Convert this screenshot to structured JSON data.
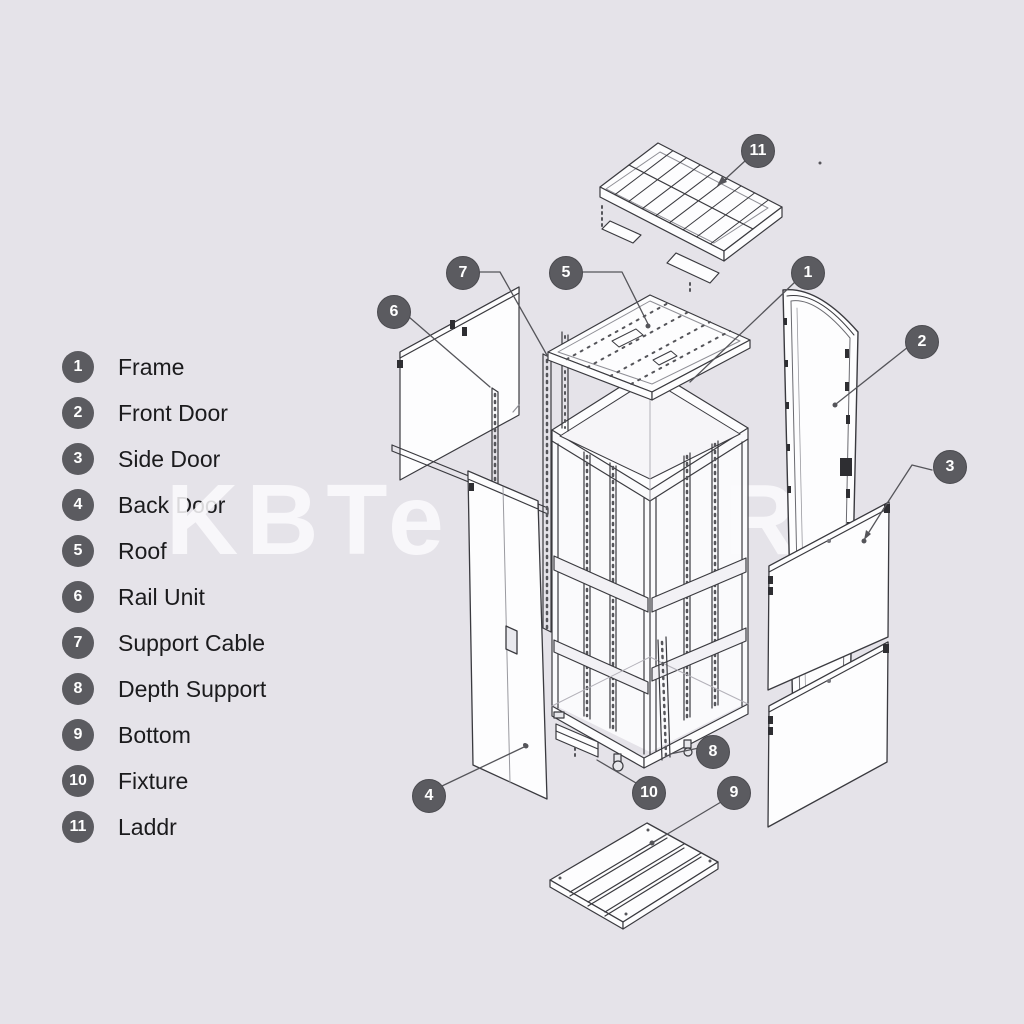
{
  "colors": {
    "background": "#e5e3e9",
    "badge": "#5b5b60",
    "badge_text": "#ffffff",
    "line": "#3a3a3f",
    "panel_fill": "#fdfdfe",
    "watermark": "#fbfafd"
  },
  "watermark": {
    "fragments": [
      "KBTe",
      "R"
    ]
  },
  "legend": {
    "items": [
      {
        "number": "1",
        "label": "Frame"
      },
      {
        "number": "2",
        "label": "Front Door"
      },
      {
        "number": "3",
        "label": "Side Door"
      },
      {
        "number": "4",
        "label": "Back Door"
      },
      {
        "number": "5",
        "label": "Roof"
      },
      {
        "number": "6",
        "label": "Rail Unit"
      },
      {
        "number": "7",
        "label": "Support Cable"
      },
      {
        "number": "8",
        "label": "Depth Support"
      },
      {
        "number": "9",
        "label": "Bottom"
      },
      {
        "number": "10",
        "label": "Fixture"
      },
      {
        "number": "11",
        "label": "Laddr"
      }
    ]
  },
  "diagram": {
    "callouts": [
      {
        "number": "1",
        "x": 807,
        "y": 272
      },
      {
        "number": "2",
        "x": 921,
        "y": 341
      },
      {
        "number": "3",
        "x": 949,
        "y": 466
      },
      {
        "number": "4",
        "x": 428,
        "y": 795
      },
      {
        "number": "5",
        "x": 565,
        "y": 272
      },
      {
        "number": "6",
        "x": 393,
        "y": 311
      },
      {
        "number": "7",
        "x": 462,
        "y": 272
      },
      {
        "number": "8",
        "x": 712,
        "y": 751
      },
      {
        "number": "9",
        "x": 733,
        "y": 792
      },
      {
        "number": "10",
        "x": 648,
        "y": 792
      },
      {
        "number": "11",
        "x": 757,
        "y": 150
      }
    ]
  }
}
